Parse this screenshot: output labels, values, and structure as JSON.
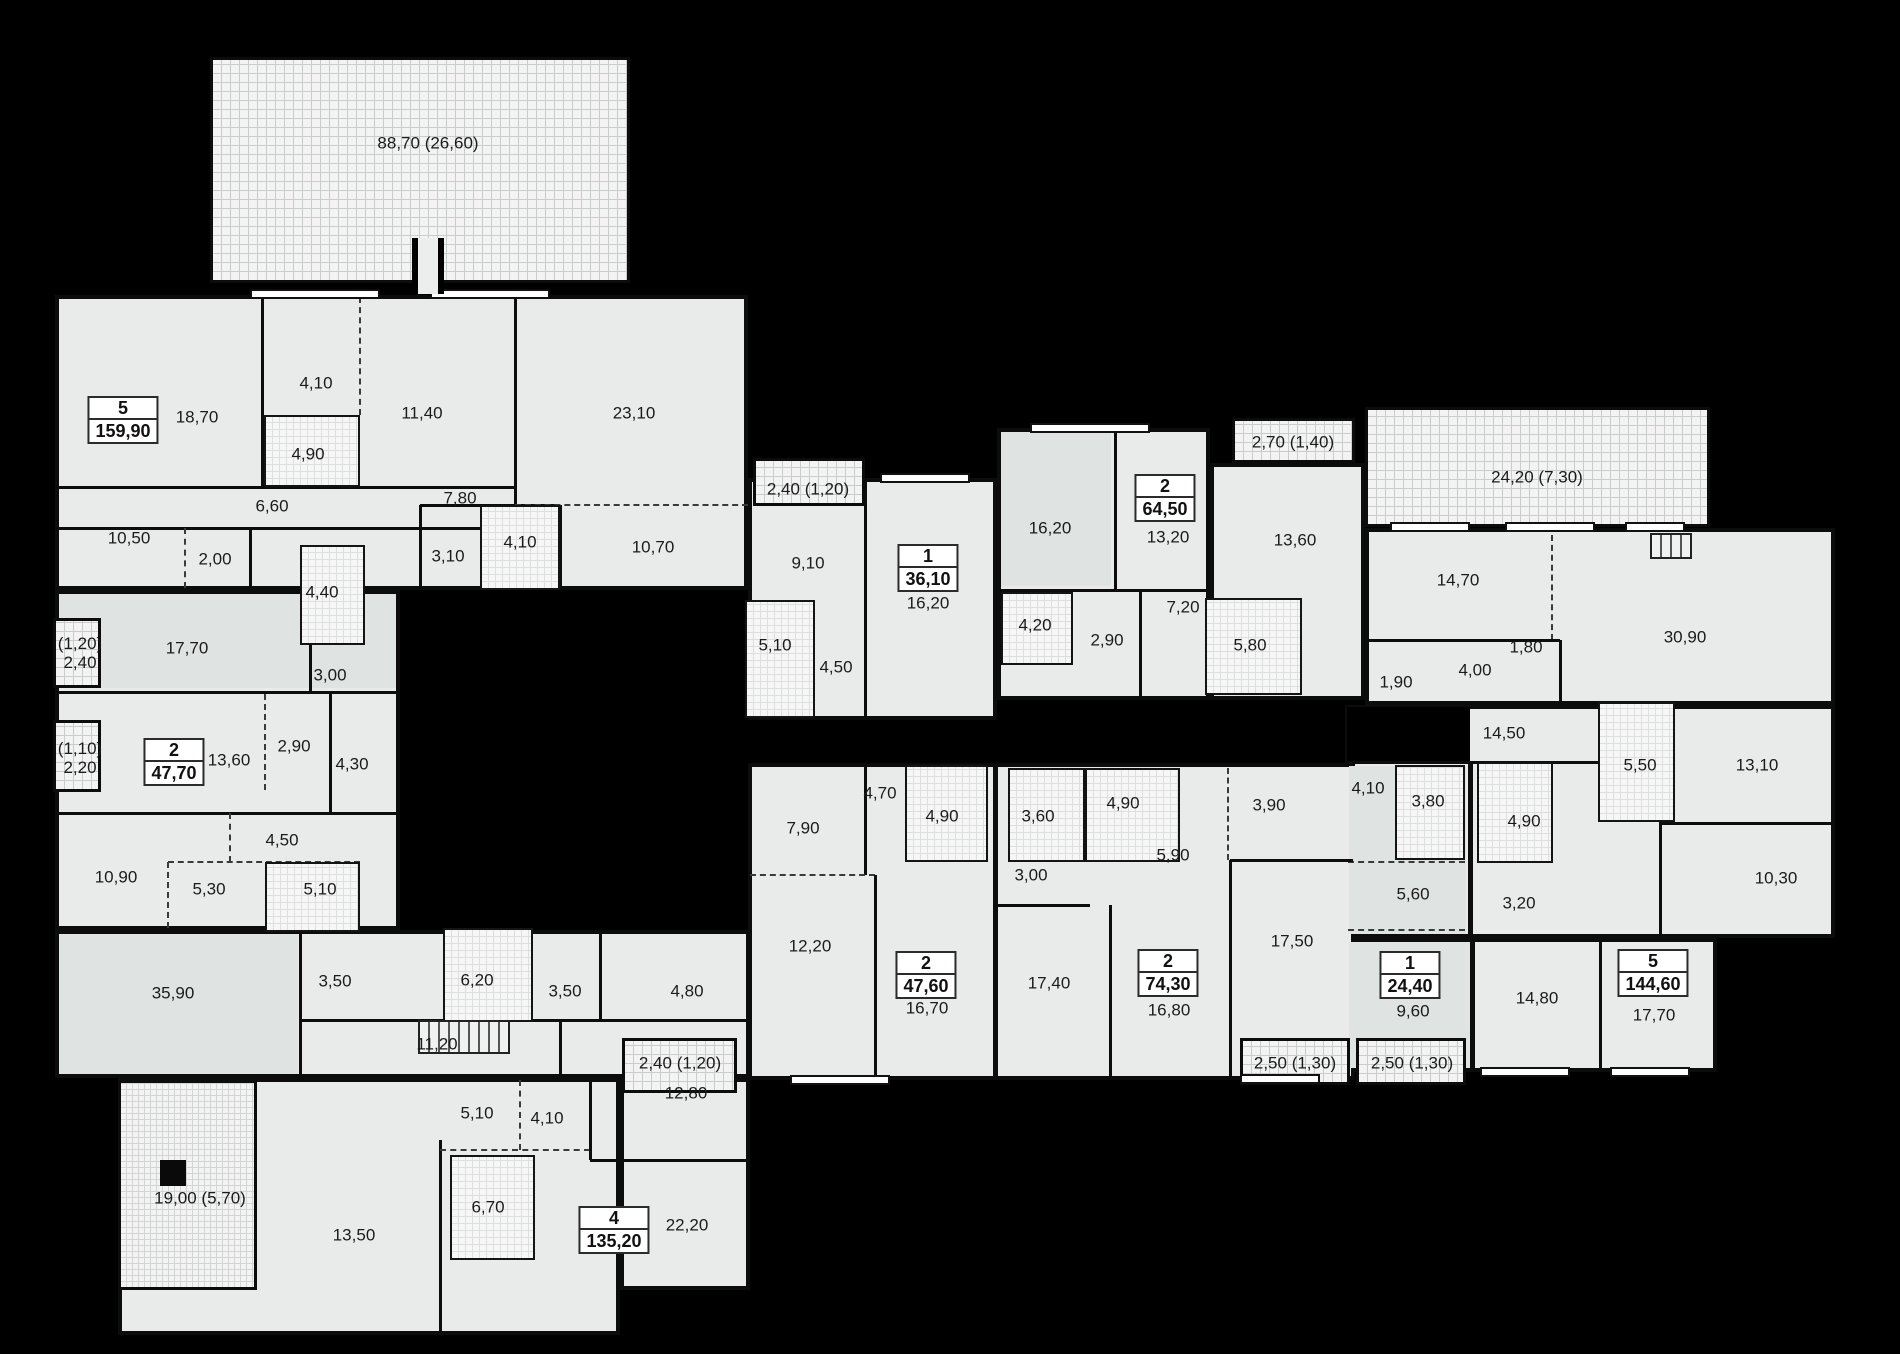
{
  "plan": {
    "w": 1900,
    "h": 1354,
    "bg": "#000000",
    "room_fill": "#e9ebeb",
    "tint_fill": "#dfe3e2",
    "wall_color": "#0d0d0d",
    "label_color": "#1b1b1b"
  },
  "apartments": [
    {
      "rooms": "5",
      "area": "159,90",
      "x": 123,
      "y": 420
    },
    {
      "rooms": "2",
      "area": "47,70",
      "x": 174,
      "y": 762
    },
    {
      "rooms": "4",
      "area": "135,20",
      "x": 614,
      "y": 1230
    },
    {
      "rooms": "1",
      "area": "36,10",
      "x": 928,
      "y": 568
    },
    {
      "rooms": "2",
      "area": "64,50",
      "x": 1165,
      "y": 498
    },
    {
      "rooms": "2",
      "area": "47,60",
      "x": 926,
      "y": 975
    },
    {
      "rooms": "2",
      "area": "74,30",
      "x": 1168,
      "y": 973
    },
    {
      "rooms": "1",
      "area": "24,40",
      "x": 1410,
      "y": 975
    },
    {
      "rooms": "5",
      "area": "144,60",
      "x": 1653,
      "y": 973
    }
  ],
  "room_labels": [
    {
      "t": "88,70 (26,60)",
      "x": 428,
      "y": 143
    },
    {
      "t": "18,70",
      "x": 197,
      "y": 417
    },
    {
      "t": "4,10",
      "x": 316,
      "y": 383
    },
    {
      "t": "11,40",
      "x": 422,
      "y": 413
    },
    {
      "t": "23,10",
      "x": 634,
      "y": 413
    },
    {
      "t": "4,90",
      "x": 308,
      "y": 454
    },
    {
      "t": "6,60",
      "x": 272,
      "y": 506
    },
    {
      "t": "7,80",
      "x": 460,
      "y": 498
    },
    {
      "t": "10,50",
      "x": 129,
      "y": 538
    },
    {
      "t": "2,00",
      "x": 215,
      "y": 559
    },
    {
      "t": "3,10",
      "x": 448,
      "y": 556
    },
    {
      "t": "4,10",
      "x": 520,
      "y": 542
    },
    {
      "t": "10,70",
      "x": 653,
      "y": 547
    },
    {
      "t": "4,40",
      "x": 322,
      "y": 592
    },
    {
      "t": "17,70",
      "x": 187,
      "y": 648
    },
    {
      "t": "3,00",
      "x": 330,
      "y": 675
    },
    {
      "t": "(1,20)\n2,40",
      "x": 80,
      "y": 653
    },
    {
      "t": "(1,10)\n2,20",
      "x": 80,
      "y": 758
    },
    {
      "t": "13,60",
      "x": 229,
      "y": 760
    },
    {
      "t": "2,90",
      "x": 294,
      "y": 746
    },
    {
      "t": "4,30",
      "x": 352,
      "y": 764
    },
    {
      "t": "4,50",
      "x": 282,
      "y": 840
    },
    {
      "t": "10,90",
      "x": 116,
      "y": 877
    },
    {
      "t": "5,30",
      "x": 209,
      "y": 889
    },
    {
      "t": "5,10",
      "x": 320,
      "y": 889
    },
    {
      "t": "35,90",
      "x": 173,
      "y": 993
    },
    {
      "t": "3,50",
      "x": 335,
      "y": 981
    },
    {
      "t": "6,20",
      "x": 477,
      "y": 980
    },
    {
      "t": "3,50",
      "x": 565,
      "y": 991
    },
    {
      "t": "4,80",
      "x": 687,
      "y": 991
    },
    {
      "t": "11,20",
      "x": 437,
      "y": 1044
    },
    {
      "t": "12,80",
      "x": 686,
      "y": 1093
    },
    {
      "t": "5,10",
      "x": 477,
      "y": 1113
    },
    {
      "t": "4,10",
      "x": 547,
      "y": 1118
    },
    {
      "t": "6,70",
      "x": 488,
      "y": 1207
    },
    {
      "t": "13,50",
      "x": 354,
      "y": 1235
    },
    {
      "t": "22,20",
      "x": 687,
      "y": 1225
    },
    {
      "t": "19,00 (5,70)",
      "x": 200,
      "y": 1198
    },
    {
      "t": "2,40 (1,20)",
      "x": 808,
      "y": 489
    },
    {
      "t": "9,10",
      "x": 808,
      "y": 563
    },
    {
      "t": "16,20",
      "x": 928,
      "y": 603
    },
    {
      "t": "5,10",
      "x": 775,
      "y": 645
    },
    {
      "t": "4,50",
      "x": 836,
      "y": 667
    },
    {
      "t": "16,20",
      "x": 1050,
      "y": 528
    },
    {
      "t": "13,20",
      "x": 1168,
      "y": 537
    },
    {
      "t": "2,70 (1,40)",
      "x": 1293,
      "y": 442
    },
    {
      "t": "13,60",
      "x": 1295,
      "y": 540
    },
    {
      "t": "4,20",
      "x": 1035,
      "y": 625
    },
    {
      "t": "2,90",
      "x": 1107,
      "y": 640
    },
    {
      "t": "7,20",
      "x": 1183,
      "y": 607
    },
    {
      "t": "5,80",
      "x": 1250,
      "y": 645
    },
    {
      "t": "24,20 (7,30)",
      "x": 1537,
      "y": 477
    },
    {
      "t": "14,70",
      "x": 1458,
      "y": 580
    },
    {
      "t": "30,90",
      "x": 1685,
      "y": 637
    },
    {
      "t": "1,80",
      "x": 1526,
      "y": 647
    },
    {
      "t": "4,00",
      "x": 1475,
      "y": 670
    },
    {
      "t": "1,90",
      "x": 1396,
      "y": 682
    },
    {
      "t": "14,50",
      "x": 1504,
      "y": 733
    },
    {
      "t": "5,50",
      "x": 1640,
      "y": 765
    },
    {
      "t": "13,10",
      "x": 1757,
      "y": 765
    },
    {
      "t": "4,90",
      "x": 1524,
      "y": 821
    },
    {
      "t": "3,20",
      "x": 1519,
      "y": 903
    },
    {
      "t": "10,30",
      "x": 1776,
      "y": 878
    },
    {
      "t": "14,80",
      "x": 1537,
      "y": 998
    },
    {
      "t": "17,70",
      "x": 1654,
      "y": 1015
    },
    {
      "t": "4,10",
      "x": 1368,
      "y": 788
    },
    {
      "t": "3,80",
      "x": 1428,
      "y": 801
    },
    {
      "t": "5,60",
      "x": 1413,
      "y": 894
    },
    {
      "t": "9,60",
      "x": 1413,
      "y": 1011
    },
    {
      "t": "2,50 (1,30)",
      "x": 1412,
      "y": 1063
    },
    {
      "t": "2,50 (1,30)",
      "x": 1295,
      "y": 1063
    },
    {
      "t": "3,90",
      "x": 1269,
      "y": 805
    },
    {
      "t": "5,90",
      "x": 1173,
      "y": 855
    },
    {
      "t": "3,00",
      "x": 1031,
      "y": 875
    },
    {
      "t": "17,40",
      "x": 1049,
      "y": 983
    },
    {
      "t": "17,50",
      "x": 1292,
      "y": 941
    },
    {
      "t": "16,80",
      "x": 1169,
      "y": 1010
    },
    {
      "t": "4,90",
      "x": 1123,
      "y": 803
    },
    {
      "t": "3,60",
      "x": 1038,
      "y": 816
    },
    {
      "t": "7,90",
      "x": 803,
      "y": 828
    },
    {
      "t": "4,70",
      "x": 880,
      "y": 793
    },
    {
      "t": "4,90",
      "x": 942,
      "y": 816
    },
    {
      "t": "12,20",
      "x": 810,
      "y": 946
    },
    {
      "t": "16,70",
      "x": 927,
      "y": 1008
    },
    {
      "t": "2,40 (1,20)",
      "x": 680,
      "y": 1063
    }
  ],
  "blocks": [
    [
      55,
      295,
      693,
      295
    ],
    [
      55,
      590,
      345,
      340
    ],
    [
      55,
      930,
      695,
      148
    ],
    [
      118,
      1078,
      502,
      257
    ],
    [
      620,
      1078,
      130,
      212
    ],
    [
      748,
      478,
      249,
      242
    ],
    [
      997,
      428,
      213,
      272
    ],
    [
      1210,
      463,
      155,
      237
    ],
    [
      1365,
      528,
      470,
      177
    ],
    [
      1345,
      705,
      490,
      233
    ],
    [
      1345,
      938,
      372,
      134
    ],
    [
      748,
      763,
      607,
      317
    ]
  ],
  "tints": [
    [
      59,
      594,
      337,
      94
    ],
    [
      59,
      934,
      239,
      140
    ],
    [
      1001,
      432,
      110,
      154
    ],
    [
      1349,
      766,
      117,
      168
    ],
    [
      1349,
      942,
      121,
      126
    ]
  ],
  "patches": [
    [
      1347,
      707,
      123,
      55
    ]
  ],
  "walls": [
    [
      262,
      297,
      262,
      487,
      "s"
    ],
    [
      360,
      297,
      360,
      415,
      "d"
    ],
    [
      515,
      297,
      515,
      505,
      "s"
    ],
    [
      57,
      487,
      515,
      487,
      "s"
    ],
    [
      57,
      528,
      560,
      528,
      "s"
    ],
    [
      185,
      528,
      185,
      588,
      "d"
    ],
    [
      250,
      528,
      250,
      588,
      "s"
    ],
    [
      420,
      505,
      560,
      505,
      "s"
    ],
    [
      420,
      505,
      420,
      588,
      "s"
    ],
    [
      560,
      505,
      560,
      588,
      "s"
    ],
    [
      515,
      505,
      748,
      505,
      "d"
    ],
    [
      57,
      692,
      398,
      692,
      "s"
    ],
    [
      310,
      645,
      310,
      692,
      "s"
    ],
    [
      57,
      813,
      398,
      813,
      "s"
    ],
    [
      330,
      692,
      330,
      813,
      "s"
    ],
    [
      265,
      694,
      265,
      790,
      "d"
    ],
    [
      230,
      813,
      230,
      862,
      "d"
    ],
    [
      168,
      862,
      360,
      862,
      "d"
    ],
    [
      168,
      862,
      168,
      928,
      "d"
    ],
    [
      300,
      932,
      300,
      1076,
      "s"
    ],
    [
      300,
      1020,
      748,
      1020,
      "s"
    ],
    [
      600,
      932,
      600,
      1020,
      "s"
    ],
    [
      560,
      1020,
      560,
      1076,
      "s"
    ],
    [
      440,
      1140,
      440,
      1333,
      "s"
    ],
    [
      440,
      1150,
      590,
      1150,
      "d"
    ],
    [
      520,
      1080,
      520,
      1150,
      "d"
    ],
    [
      590,
      1078,
      590,
      1160,
      "s"
    ],
    [
      590,
      1160,
      748,
      1160,
      "s"
    ],
    [
      865,
      480,
      865,
      718,
      "s"
    ],
    [
      1115,
      430,
      1115,
      590,
      "s"
    ],
    [
      1001,
      590,
      1208,
      590,
      "s"
    ],
    [
      1140,
      592,
      1140,
      698,
      "s"
    ],
    [
      1210,
      465,
      1210,
      698,
      "s"
    ],
    [
      1552,
      535,
      1552,
      640,
      "d"
    ],
    [
      1367,
      640,
      1560,
      640,
      "s"
    ],
    [
      1560,
      640,
      1560,
      703,
      "s"
    ],
    [
      1347,
      762,
      1598,
      762,
      "s"
    ],
    [
      1660,
      707,
      1660,
      936,
      "s"
    ],
    [
      1660,
      823,
      1833,
      823,
      "s"
    ],
    [
      1470,
      762,
      1470,
      936,
      "t"
    ],
    [
      1348,
      862,
      1465,
      862,
      "d"
    ],
    [
      1348,
      930,
      1465,
      930,
      "d"
    ],
    [
      1472,
      940,
      1472,
      1070,
      "t"
    ],
    [
      1600,
      940,
      1600,
      1070,
      "s"
    ],
    [
      995,
      765,
      995,
      1078,
      "t"
    ],
    [
      865,
      765,
      865,
      875,
      "s"
    ],
    [
      750,
      875,
      875,
      875,
      "d"
    ],
    [
      875,
      875,
      875,
      1078,
      "s"
    ],
    [
      997,
      905,
      1090,
      905,
      "s"
    ],
    [
      1110,
      905,
      1110,
      1078,
      "s"
    ],
    [
      1230,
      860,
      1230,
      1078,
      "s"
    ],
    [
      1230,
      860,
      1353,
      860,
      "s"
    ],
    [
      1228,
      768,
      1228,
      860,
      "d"
    ]
  ],
  "bathrooms": [
    [
      264,
      415,
      96,
      72
    ],
    [
      480,
      505,
      80,
      85
    ],
    [
      300,
      545,
      65,
      100
    ],
    [
      265,
      862,
      95,
      70
    ],
    [
      443,
      928,
      90,
      94
    ],
    [
      450,
      1155,
      85,
      105
    ],
    [
      745,
      600,
      70,
      118
    ],
    [
      1001,
      592,
      72,
      73
    ],
    [
      1205,
      598,
      97,
      97
    ],
    [
      905,
      765,
      83,
      97
    ],
    [
      1008,
      768,
      77,
      94
    ],
    [
      1085,
      768,
      95,
      94
    ],
    [
      1395,
      765,
      70,
      95
    ],
    [
      1477,
      762,
      76,
      101
    ],
    [
      1598,
      702,
      77,
      120
    ]
  ],
  "hatched": [
    {
      "x": 210,
      "y": 57,
      "w": 420,
      "h": 226,
      "fine": false
    },
    {
      "x": 1365,
      "y": 407,
      "w": 345,
      "h": 120,
      "fine": false
    },
    {
      "x": 753,
      "y": 458,
      "w": 112,
      "h": 48,
      "fine": false
    },
    {
      "x": 1232,
      "y": 418,
      "w": 123,
      "h": 45,
      "fine": false
    },
    {
      "x": 53,
      "y": 618,
      "w": 48,
      "h": 70,
      "fine": false
    },
    {
      "x": 53,
      "y": 720,
      "w": 48,
      "h": 72,
      "fine": false
    },
    {
      "x": 622,
      "y": 1038,
      "w": 115,
      "h": 55,
      "fine": false
    },
    {
      "x": 1240,
      "y": 1038,
      "w": 110,
      "h": 47,
      "fine": false
    },
    {
      "x": 1356,
      "y": 1038,
      "w": 110,
      "h": 47,
      "fine": false
    },
    {
      "x": 118,
      "y": 1080,
      "w": 139,
      "h": 210,
      "fine": true
    }
  ],
  "windows": [
    [
      250,
      289,
      130
    ],
    [
      430,
      289,
      120
    ],
    [
      880,
      473,
      90
    ],
    [
      1030,
      423,
      120
    ],
    [
      1390,
      522,
      80
    ],
    [
      1505,
      522,
      90
    ],
    [
      1625,
      522,
      60
    ],
    [
      790,
      1075,
      100
    ],
    [
      1240,
      1074,
      80
    ],
    [
      1480,
      1067,
      90
    ],
    [
      1610,
      1067,
      80
    ]
  ],
  "stairs": [
    [
      418,
      1020,
      92,
      34
    ],
    [
      1650,
      533,
      42,
      26
    ]
  ],
  "notch": [
    412,
    238,
    32,
    56
  ],
  "black_square": [
    160,
    1160,
    26,
    26
  ]
}
